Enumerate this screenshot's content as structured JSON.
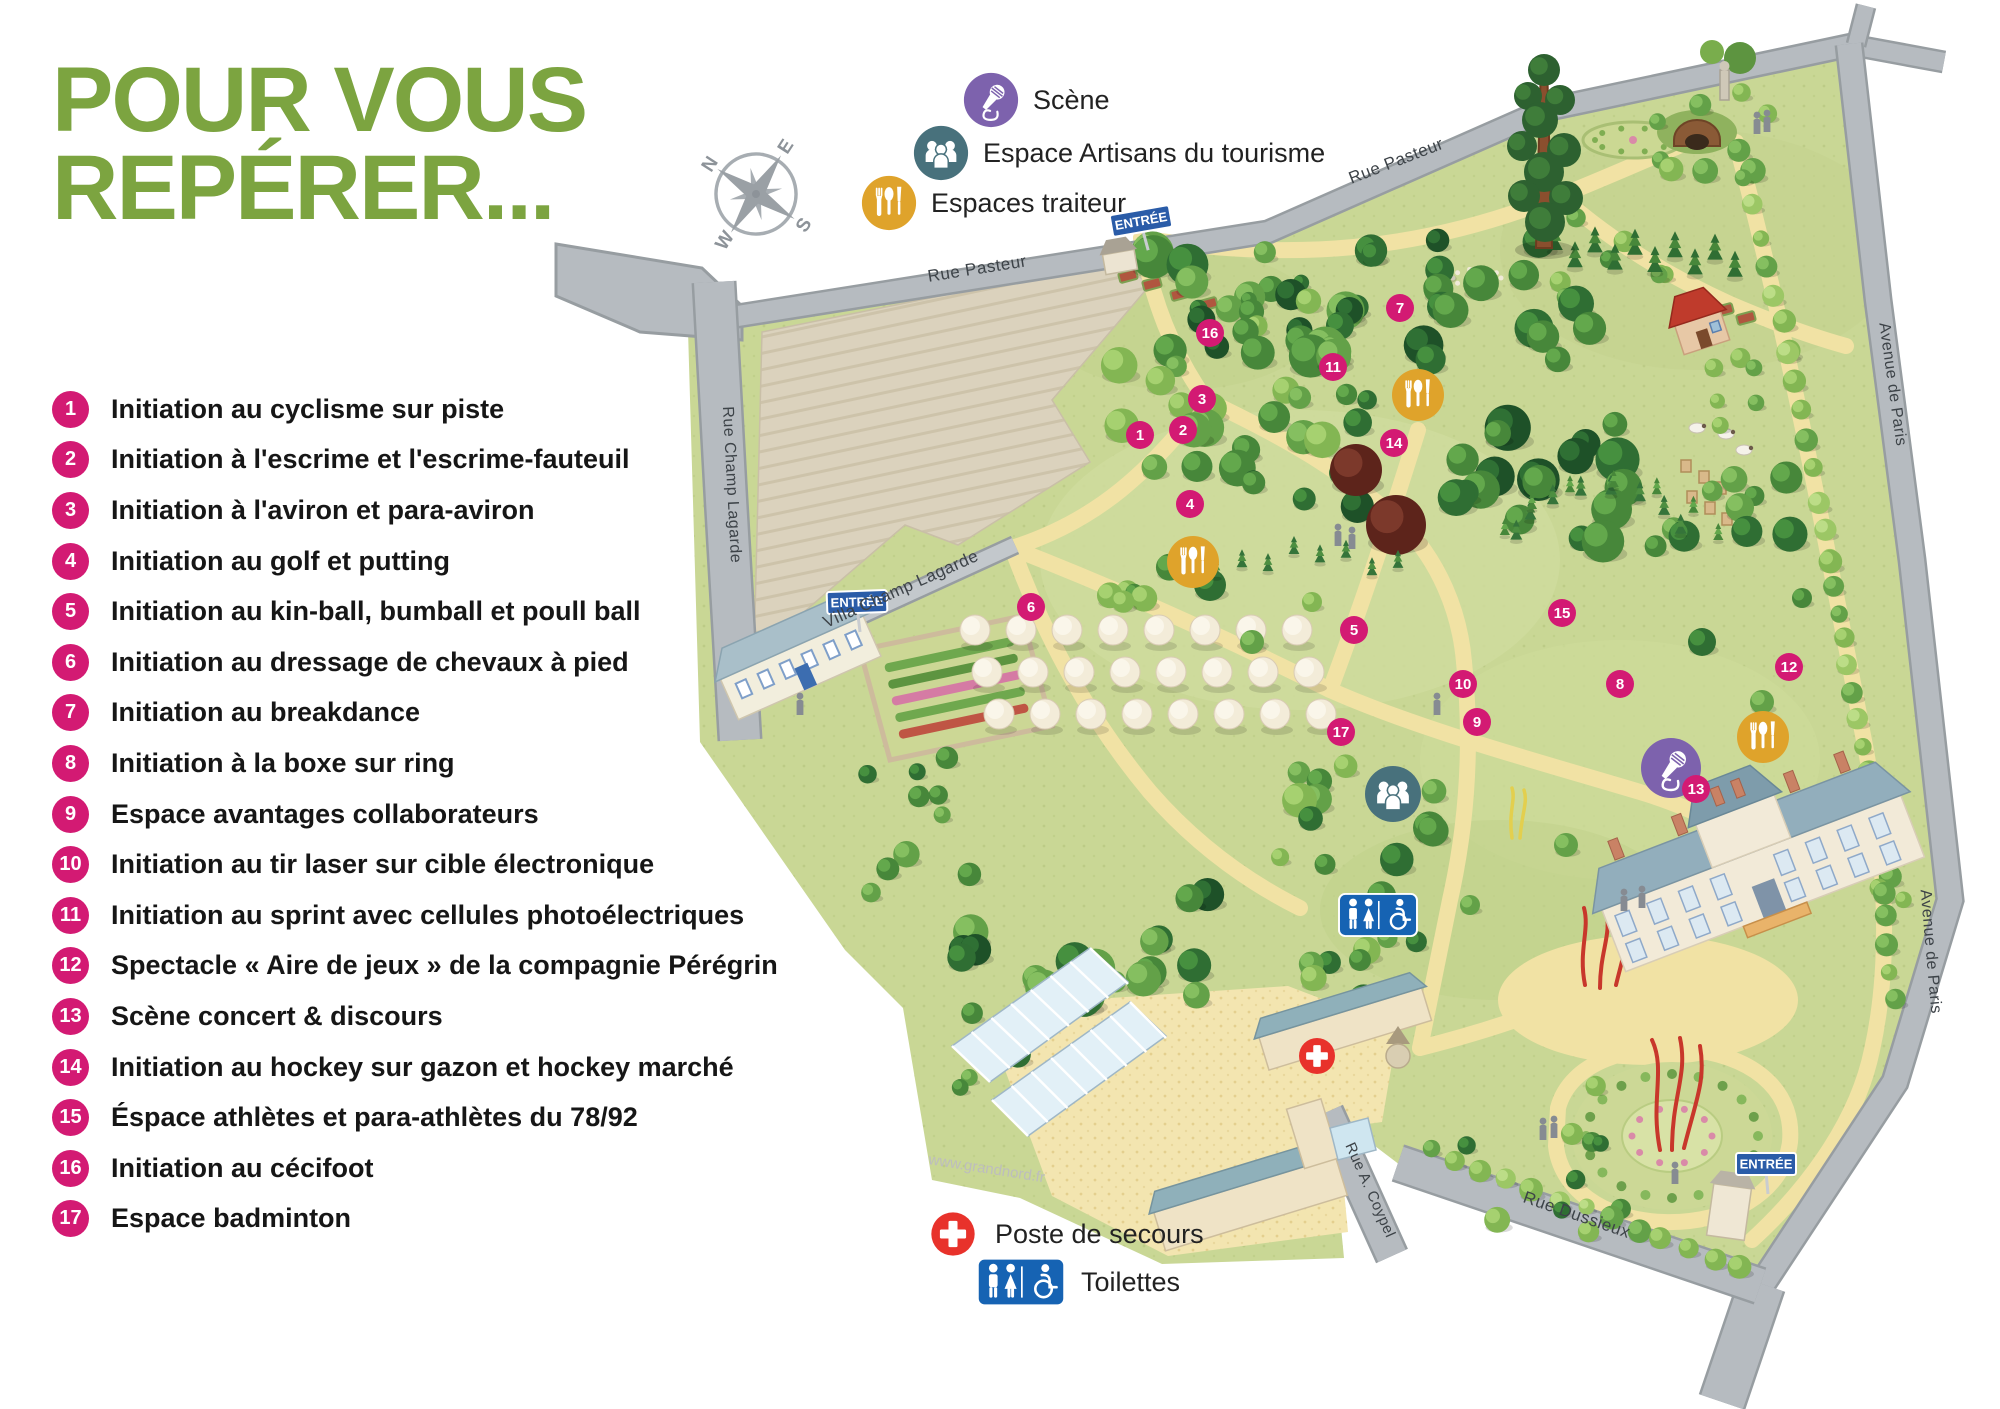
{
  "title": {
    "line1": "POUR VOUS",
    "line2": "REPÉRER..."
  },
  "colors": {
    "title_green": "#7ca440",
    "marker_pink": "#d31a73",
    "scene_purple": "#7d62ad",
    "artisans_teal": "#48717c",
    "traiteur_yellow": "#dfa32b",
    "secours_red": "#e8322b",
    "toilettes_blue": "#1663b3",
    "entree_blue": "#2a5ca8"
  },
  "legend": {
    "items": [
      {
        "num": "1",
        "label": "Initiation au cyclisme sur piste"
      },
      {
        "num": "2",
        "label": "Initiation à l'escrime et l'escrime-fauteuil"
      },
      {
        "num": "3",
        "label": "Initiation à l'aviron et para-aviron"
      },
      {
        "num": "4",
        "label": "Initiation au golf et putting"
      },
      {
        "num": "5",
        "label": "Initiation au kin-ball, bumball et poull ball"
      },
      {
        "num": "6",
        "label": "Initiation au dressage de chevaux à pied"
      },
      {
        "num": "7",
        "label": "Initiation au breakdance"
      },
      {
        "num": "8",
        "label": "Initiation à la boxe sur ring"
      },
      {
        "num": "9",
        "label": "Espace avantages collaborateurs"
      },
      {
        "num": "10",
        "label": "Initiation au tir laser sur cible électronique"
      },
      {
        "num": "11",
        "label": "Initiation au sprint avec cellules photoélectriques"
      },
      {
        "num": "12",
        "label": "Spectacle « Aire de jeux » de la compagnie Pérégrin"
      },
      {
        "num": "13",
        "label": "Scène concert & discours"
      },
      {
        "num": "14",
        "label": "Initiation au hockey sur gazon et hockey marché"
      },
      {
        "num": "15",
        "label": "Éspace athlètes et para-athlètes du 78/92"
      },
      {
        "num": "16",
        "label": "Initiation au cécifoot"
      },
      {
        "num": "17",
        "label": "Espace badminton"
      }
    ]
  },
  "map_key_top": [
    {
      "id": "scene",
      "icon": "microphone-icon",
      "label": "Scène",
      "x": 963,
      "y": 72
    },
    {
      "id": "artisans",
      "icon": "people-icon",
      "label": "Espace Artisans du tourisme",
      "x": 913,
      "y": 125
    },
    {
      "id": "traiteur",
      "icon": "cutlery-icon",
      "label": "Espaces traiteur",
      "x": 861,
      "y": 175
    }
  ],
  "map_key_bottom": [
    {
      "id": "secours",
      "icon": "first-aid-cross-icon",
      "label": "Poste de secours",
      "x": 925,
      "y": 1206
    },
    {
      "id": "toilettes",
      "icon": "toilets-sign-icon",
      "label": "Toilettes",
      "x": 975,
      "y": 1256
    }
  ],
  "map": {
    "watermark": "www.grandnord.fr",
    "compass": {
      "labels": [
        "N",
        "E",
        "S",
        "W"
      ]
    },
    "streets": [
      {
        "name": "Rue Pasteur",
        "x": 978,
        "y": 274,
        "rot": -9,
        "size": 17
      },
      {
        "name": "Rue Pasteur",
        "x": 1398,
        "y": 166,
        "rot": -21,
        "size": 17
      },
      {
        "name": "Rue Champ Lagarde",
        "x": 727,
        "y": 485,
        "rot": 87,
        "size": 16
      },
      {
        "name": "Villa Champ Lagarde",
        "x": 903,
        "y": 594,
        "rot": -24,
        "size": 17
      },
      {
        "name": "Avenue de Paris",
        "x": 1888,
        "y": 385,
        "rot": 82,
        "size": 16
      },
      {
        "name": "Avenue de Paris",
        "x": 1926,
        "y": 952,
        "rot": 85,
        "size": 16
      },
      {
        "name": "Rue Dussieux",
        "x": 1575,
        "y": 1220,
        "rot": 19,
        "size": 17
      },
      {
        "name": "Rue A. Coypel",
        "x": 1366,
        "y": 1192,
        "rot": 66,
        "size": 15
      }
    ],
    "entrances": [
      {
        "label": "ENTRÉE",
        "x": 1141,
        "y": 221,
        "rot": -10
      },
      {
        "label": "ENTRÉE",
        "x": 857,
        "y": 602,
        "rot": -2
      },
      {
        "label": "ENTRÉE",
        "x": 1766,
        "y": 1164,
        "rot": 0
      }
    ],
    "markers": [
      {
        "num": "1",
        "x": 1140,
        "y": 435
      },
      {
        "num": "2",
        "x": 1183,
        "y": 430
      },
      {
        "num": "3",
        "x": 1202,
        "y": 399
      },
      {
        "num": "4",
        "x": 1190,
        "y": 504
      },
      {
        "num": "5",
        "x": 1354,
        "y": 630
      },
      {
        "num": "6",
        "x": 1031,
        "y": 607
      },
      {
        "num": "7",
        "x": 1400,
        "y": 308
      },
      {
        "num": "8",
        "x": 1620,
        "y": 684
      },
      {
        "num": "9",
        "x": 1477,
        "y": 722
      },
      {
        "num": "10",
        "x": 1463,
        "y": 684
      },
      {
        "num": "11",
        "x": 1333,
        "y": 367
      },
      {
        "num": "12",
        "x": 1789,
        "y": 667
      },
      {
        "num": "13",
        "x": 1696,
        "y": 789
      },
      {
        "num": "14",
        "x": 1394,
        "y": 443
      },
      {
        "num": "15",
        "x": 1562,
        "y": 613
      },
      {
        "num": "16",
        "x": 1210,
        "y": 333
      },
      {
        "num": "17",
        "x": 1341,
        "y": 732
      }
    ],
    "icons": [
      {
        "type": "traiteur",
        "icon": "cutlery-icon",
        "x": 1418,
        "y": 395,
        "r": 26
      },
      {
        "type": "traiteur",
        "icon": "cutlery-icon",
        "x": 1193,
        "y": 562,
        "r": 26
      },
      {
        "type": "traiteur",
        "icon": "cutlery-icon",
        "x": 1763,
        "y": 737,
        "r": 26
      },
      {
        "type": "scene",
        "icon": "microphone-icon",
        "x": 1671,
        "y": 768,
        "r": 30
      },
      {
        "type": "artisans",
        "icon": "people-icon",
        "x": 1393,
        "y": 794,
        "r": 28
      },
      {
        "type": "toilettes",
        "icon": "toilets-sign-icon",
        "x": 1378,
        "y": 915
      },
      {
        "type": "secours",
        "icon": "first-aid-cross-icon",
        "x": 1317,
        "y": 1056,
        "r": 18
      }
    ]
  }
}
